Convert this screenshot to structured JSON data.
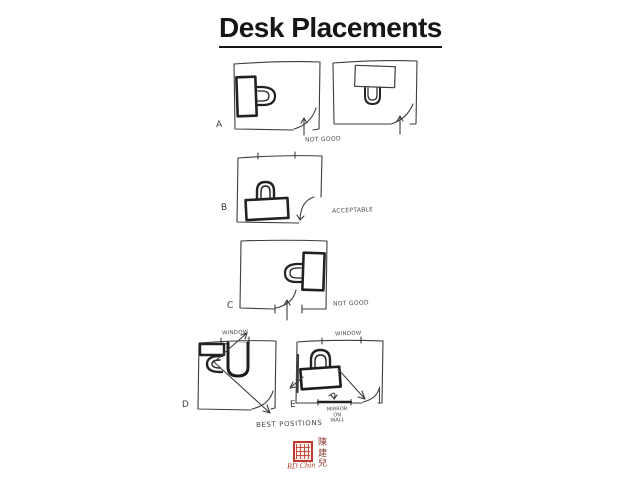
{
  "title": "Desk Placements",
  "diagrams": {
    "a": {
      "label": "A",
      "annotation": "NOT GOOD"
    },
    "b": {
      "label": "B",
      "annotation": "ACCEPTABLE"
    },
    "c": {
      "label": "C",
      "annotation": "NOT GOOD"
    },
    "d": {
      "label": "D",
      "window_label": "WINDOW"
    },
    "e": {
      "label": "E",
      "window_label": "WINDOW",
      "mirror_label": {
        "line1": "MIRROR",
        "line2": "ON",
        "line3": "WALL"
      }
    }
  },
  "caption": "BEST POSITIONS",
  "signature": {
    "chinese_name": [
      "陳",
      "建",
      "兒"
    ],
    "romanized_name": "RD Chin",
    "seal_color": "#bf3a2c"
  },
  "colors": {
    "ink": "#3d3d3d",
    "furniture_ink": "#222222",
    "background": "#ffffff"
  }
}
